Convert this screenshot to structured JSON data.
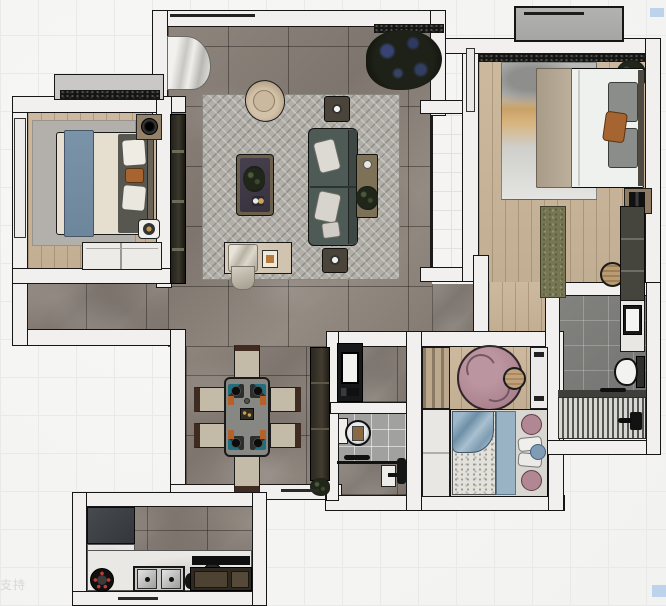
{
  "watermark": {
    "text": "支持"
  },
  "ui_artifacts": {
    "selection_highlight_color": "#bdd3ec",
    "marks": [
      {
        "x": 650,
        "y": 8
      },
      {
        "x": 652,
        "y": 585
      }
    ]
  },
  "palette": {
    "background_tile": "#f4f4f2",
    "wall": "#f1f0ee",
    "marble_floor": "#877e76",
    "wood_floor": "#c8b499",
    "white_tile": "#f5f4f2",
    "bath_tile_light": "#a1a19f",
    "bath_tile_dark": "#7c7c7a",
    "rug_gray": "#b2afa9",
    "rug_pink": "#b18b95",
    "sofa": "#4e5a56",
    "throw_blue": "#7b93a8",
    "pillow_orange": "#a56430",
    "cabinet_dark": "#35302a"
  },
  "floorplan": {
    "type": "apartment-top-down-3d-render",
    "rooms": [
      {
        "id": "living-room",
        "floor": "gray-marble",
        "furniture": [
          "area-rug",
          "sofa",
          "coffee-table",
          "armchair",
          "tv-media-wall",
          "side-table-top",
          "side-table-bottom",
          "console-table",
          "bench",
          "curtain",
          "floor-plant"
        ]
      },
      {
        "id": "dining-area",
        "floor": "gray-marble",
        "furniture": [
          "dining-table",
          "six-chairs",
          "tall-cabinet",
          "cabinet-plant"
        ]
      },
      {
        "id": "bedroom-left",
        "floor": "wood",
        "furniture": [
          "double-bed",
          "blue-throw",
          "rug",
          "nightstand-lamp",
          "floor-tray",
          "sliding-wardrobe",
          "bay-window"
        ]
      },
      {
        "id": "bedroom-master",
        "floor": "wood",
        "furniture": [
          "double-bed",
          "art-print-rug",
          "gray-pillows",
          "orange-pillow",
          "nightstand",
          "runner-rug",
          "rattan-pouf",
          "wardrobe",
          "corner-plant",
          "ac-outdoor-unit"
        ]
      },
      {
        "id": "bedroom-kids",
        "floor": "wood",
        "furniture": [
          "single-bed",
          "blue-blanket",
          "pink-round-rug",
          "pouf",
          "plank-wardrobe",
          "white-wardrobe",
          "white-desk-unit",
          "pink-pillows"
        ]
      },
      {
        "id": "kitchen",
        "floor": "gray-marble",
        "furniture": [
          "fridge",
          "white-counter",
          "gas-burner",
          "double-sink",
          "faucet-kettle",
          "round-basin",
          "range-hood",
          "brown-cabinets"
        ]
      },
      {
        "id": "bathroom-ensuite",
        "floor": "dark-tile",
        "furniture": [
          "vanity-sink",
          "toilet",
          "teak-shower-floor",
          "shower-set"
        ]
      },
      {
        "id": "bathroom-small",
        "floor": "light-tile",
        "furniture": [
          "round-mirror",
          "washbasin",
          "glass-partition",
          "shower-set",
          "toilet"
        ]
      },
      {
        "id": "vanity-niche",
        "floor": "gray-marble",
        "furniture": [
          "black-vanity",
          "mirror"
        ]
      },
      {
        "id": "balcony-strip",
        "floor": "white-tile",
        "furniture": [
          "glass-door"
        ]
      }
    ]
  }
}
